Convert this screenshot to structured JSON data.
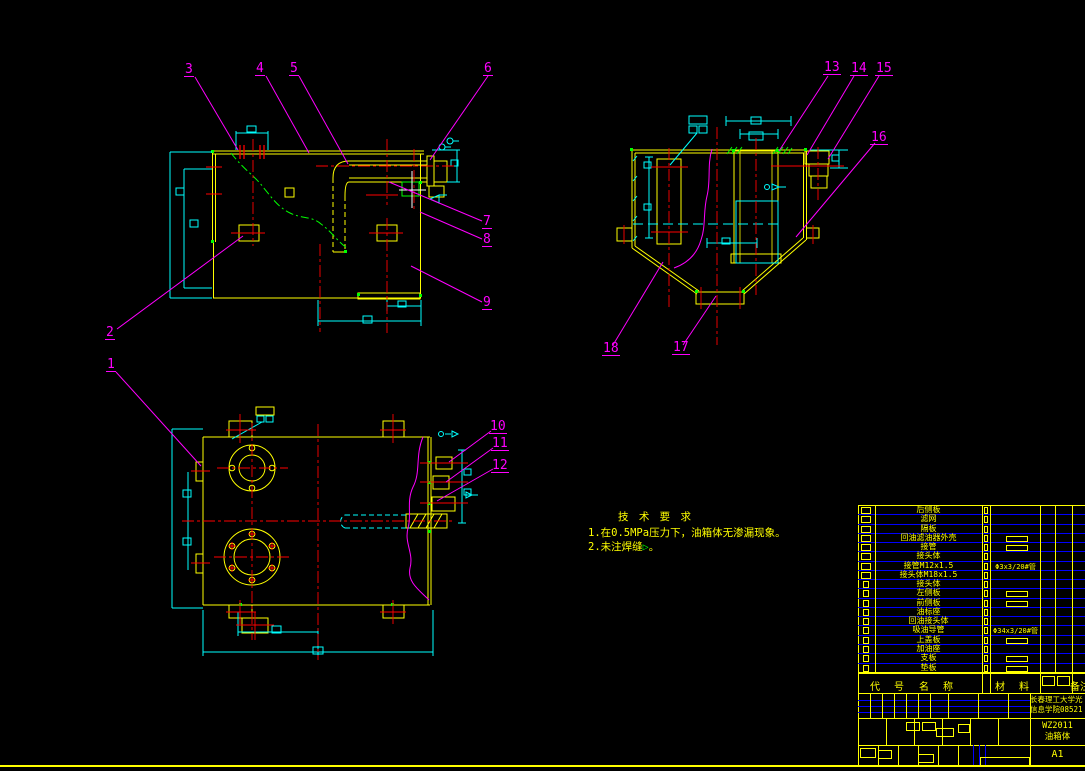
{
  "colors": {
    "background": "#000000",
    "outline": "#FFFF00",
    "dimension": "#00FFFF",
    "centerline": "#FF0000",
    "leader": "#FF00FF",
    "phantom_weld": "#00FF00",
    "table_row_line": "#0000FF",
    "highlight": "#FFFFFF"
  },
  "balloons": [
    "1",
    "2",
    "3",
    "4",
    "5",
    "6",
    "7",
    "8",
    "9",
    "10",
    "11",
    "12",
    "13",
    "14",
    "15",
    "16",
    "17",
    "18"
  ],
  "tech_requirements": {
    "title": "技 术 要 求",
    "item1": "1.在0.5MPa压力下，油箱体无渗漏现象。",
    "item2_text": "2.未注焊缝",
    "item2_symbol": "▷",
    "item2_suffix": "。"
  },
  "parts_list": {
    "header": {
      "code": "代 号",
      "name": "名 称",
      "material": "材 料",
      "remark": "备注"
    },
    "rows": [
      {
        "seq": "18",
        "name": "后侧板",
        "material": "",
        "material_box": false
      },
      {
        "seq": "17",
        "name": "滤网",
        "material": "",
        "material_box": false
      },
      {
        "seq": "16",
        "name": "隔板",
        "material": "",
        "material_box": false
      },
      {
        "seq": "15",
        "name": "回油滤油器外壳",
        "material": "",
        "material_box": true
      },
      {
        "seq": "14",
        "name": "接管",
        "material": "",
        "material_box": true
      },
      {
        "seq": "13",
        "name": "接头体",
        "material": "",
        "material_box": false
      },
      {
        "seq": "12",
        "name": "接管M12x1.5",
        "material": "Φ3x3/20#管",
        "material_box": false
      },
      {
        "seq": "11",
        "name": "接头体M18x1.5",
        "material": "",
        "material_box": false
      },
      {
        "seq": "10",
        "name": "接头体",
        "material": "",
        "material_box": false
      },
      {
        "seq": "9",
        "name": "左侧板",
        "material": "",
        "material_box": true
      },
      {
        "seq": "8",
        "name": "前侧板",
        "material": "",
        "material_box": true
      },
      {
        "seq": "7",
        "name": "油标座",
        "material": "",
        "material_box": false
      },
      {
        "seq": "6",
        "name": "回油接头体",
        "material": "",
        "material_box": false
      },
      {
        "seq": "5",
        "name": "吸油导管",
        "material": "Φ34x3/20#管",
        "material_box": false
      },
      {
        "seq": "4",
        "name": "上盖板",
        "material": "",
        "material_box": true
      },
      {
        "seq": "3",
        "name": "加油座",
        "material": "",
        "material_box": false
      },
      {
        "seq": "2",
        "name": "支板",
        "material": "",
        "material_box": true
      },
      {
        "seq": "1",
        "name": "垫板",
        "material": "",
        "material_box": true
      }
    ]
  },
  "title_block": {
    "school_line1": "长春理工大学光",
    "school_line2": "信息学院08521",
    "drawing_no": "WZ2011",
    "part_name": "油箱体",
    "sheet_size": "A1"
  }
}
